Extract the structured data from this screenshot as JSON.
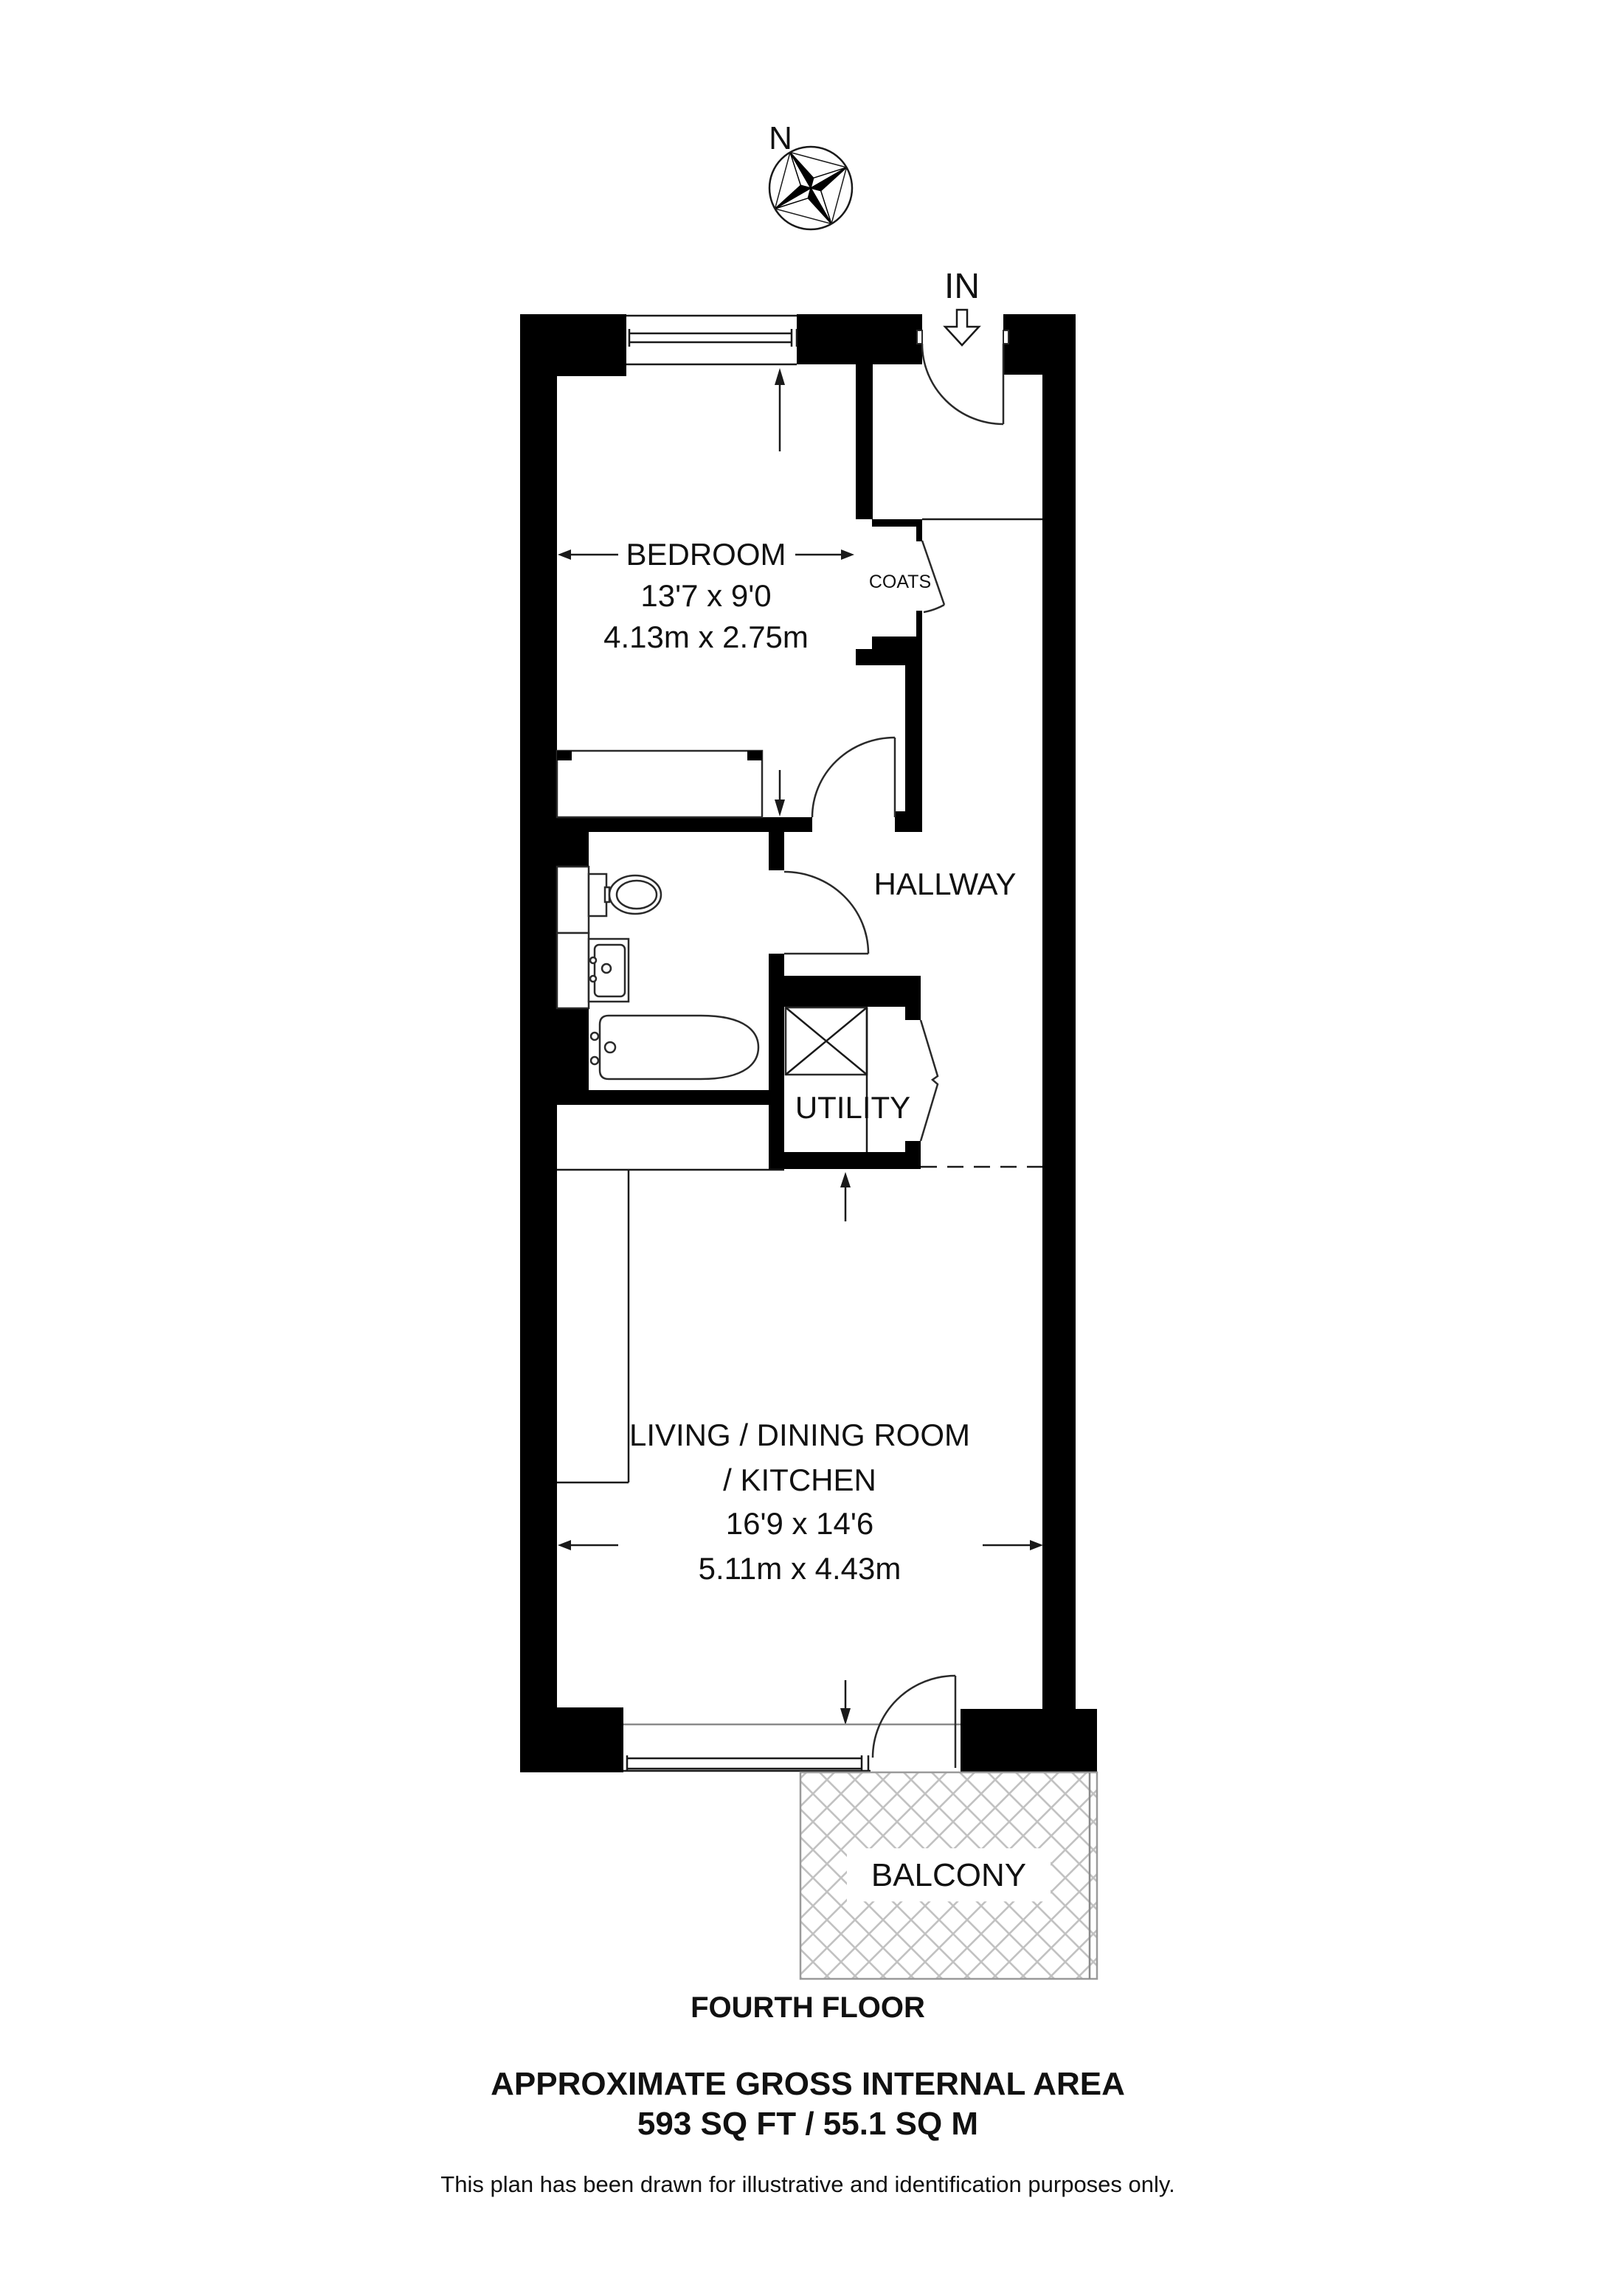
{
  "compass": {
    "north_label": "N"
  },
  "entrance": {
    "label": "IN"
  },
  "rooms": {
    "bedroom": {
      "name": "BEDROOM",
      "size_imperial": "13'7 x 9'0",
      "size_metric": "4.13m x 2.75m"
    },
    "coats": {
      "name": "COATS"
    },
    "hallway": {
      "name": "HALLWAY"
    },
    "utility": {
      "name": "UTILITY"
    },
    "living": {
      "name_line1": "LIVING / DINING ROOM",
      "name_line2": "/ KITCHEN",
      "size_imperial": "16'9 x 14'6",
      "size_metric": "5.11m x 4.43m"
    },
    "balcony": {
      "name": "BALCONY"
    }
  },
  "footer": {
    "floor_label": "FOURTH FLOOR",
    "area_title": "APPROXIMATE GROSS INTERNAL AREA",
    "area_value": "593 SQ FT / 55.1 SQ M",
    "disclaimer": "This plan has been drawn for illustrative and identification purposes only."
  },
  "colors": {
    "wall": "#000000",
    "line": "#1a1a1a",
    "hatch": "#c2c2c2",
    "background": "#ffffff"
  }
}
